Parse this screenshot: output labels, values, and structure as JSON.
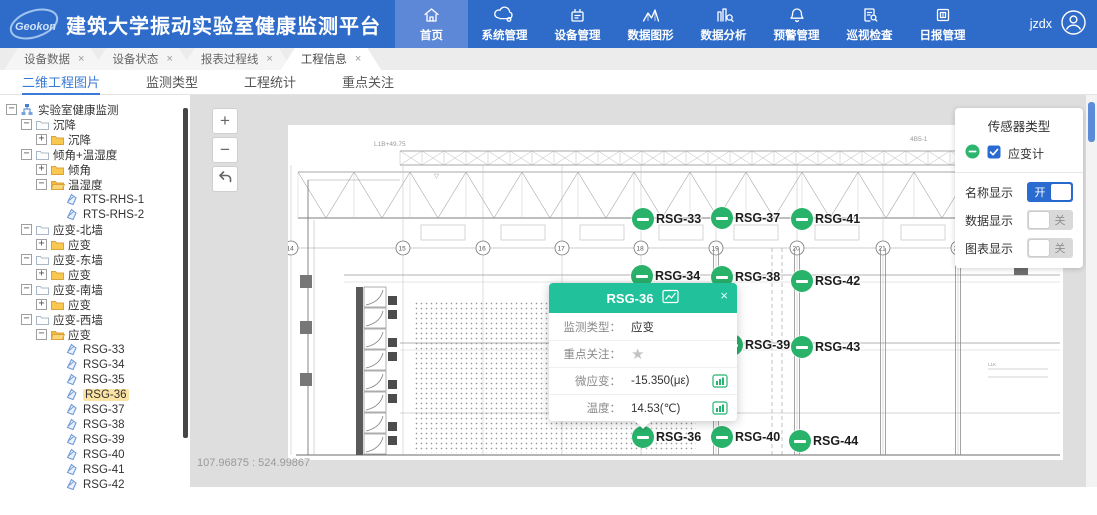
{
  "header": {
    "logo_text": "Geokon",
    "title": "建筑大学振动实验室健康监测平台",
    "user": "jzdx",
    "nav": [
      {
        "label": "首页",
        "icon": "home-icon",
        "active": true
      },
      {
        "label": "系统管理",
        "icon": "cloud-gear-icon"
      },
      {
        "label": "设备管理",
        "icon": "device-icon"
      },
      {
        "label": "数据图形",
        "icon": "chart-icon"
      },
      {
        "label": "数据分析",
        "icon": "analysis-icon"
      },
      {
        "label": "预警管理",
        "icon": "bell-icon"
      },
      {
        "label": "巡视检查",
        "icon": "inspect-icon"
      },
      {
        "label": "日报管理",
        "icon": "report-icon"
      }
    ]
  },
  "window_tabs": [
    {
      "label": "设备数据",
      "close": "×",
      "active": false
    },
    {
      "label": "设备状态",
      "close": "×",
      "active": false
    },
    {
      "label": "报表过程线",
      "close": "×",
      "active": false
    },
    {
      "label": "工程信息",
      "close": "×",
      "active": true
    }
  ],
  "subtabs": [
    {
      "label": "二维工程图片",
      "active": true
    },
    {
      "label": "监测类型",
      "active": false
    },
    {
      "label": "工程统计",
      "active": false
    },
    {
      "label": "重点关注",
      "active": false
    }
  ],
  "tree": {
    "items": [
      {
        "label": "实验室健康监测",
        "level": 0,
        "exp": "−",
        "icon": "org-icon"
      },
      {
        "label": "沉降",
        "level": 1,
        "exp": "−",
        "icon": "folder-light-icon"
      },
      {
        "label": "沉降",
        "level": 2,
        "exp": "+",
        "icon": "folder-icon"
      },
      {
        "label": "倾角+温湿度",
        "level": 1,
        "exp": "−",
        "icon": "folder-light-icon"
      },
      {
        "label": "倾角",
        "level": 2,
        "exp": "+",
        "icon": "folder-icon"
      },
      {
        "label": "温湿度",
        "level": 2,
        "exp": "−",
        "icon": "folder-open-icon"
      },
      {
        "label": "RTS-RHS-1",
        "level": 3,
        "icon": "sensor-icon"
      },
      {
        "label": "RTS-RHS-2",
        "level": 3,
        "icon": "sensor-icon"
      },
      {
        "label": "应变-北墙",
        "level": 1,
        "exp": "−",
        "icon": "folder-light-icon"
      },
      {
        "label": "应变",
        "level": 2,
        "exp": "+",
        "icon": "folder-icon"
      },
      {
        "label": "应变-东墙",
        "level": 1,
        "exp": "−",
        "icon": "folder-light-icon"
      },
      {
        "label": "应变",
        "level": 2,
        "exp": "+",
        "icon": "folder-icon"
      },
      {
        "label": "应变-南墙",
        "level": 1,
        "exp": "−",
        "icon": "folder-light-icon"
      },
      {
        "label": "应变",
        "level": 2,
        "exp": "+",
        "icon": "folder-icon"
      },
      {
        "label": "应变-西墙",
        "level": 1,
        "exp": "−",
        "icon": "folder-light-icon"
      },
      {
        "label": "应变",
        "level": 2,
        "exp": "−",
        "icon": "folder-open-icon"
      },
      {
        "label": "RSG-33",
        "level": 3,
        "icon": "sensor-icon"
      },
      {
        "label": "RSG-34",
        "level": 3,
        "icon": "sensor-icon"
      },
      {
        "label": "RSG-35",
        "level": 3,
        "icon": "sensor-icon"
      },
      {
        "label": "RSG-36",
        "level": 3,
        "icon": "sensor-icon",
        "selected": true
      },
      {
        "label": "RSG-37",
        "level": 3,
        "icon": "sensor-icon"
      },
      {
        "label": "RSG-38",
        "level": 3,
        "icon": "sensor-icon"
      },
      {
        "label": "RSG-39",
        "level": 3,
        "icon": "sensor-icon"
      },
      {
        "label": "RSG-40",
        "level": 3,
        "icon": "sensor-icon"
      },
      {
        "label": "RSG-41",
        "level": 3,
        "icon": "sensor-icon"
      },
      {
        "label": "RSG-42",
        "level": 3,
        "icon": "sensor-icon"
      }
    ]
  },
  "canvas": {
    "zoom_in": "+",
    "zoom_out": "−",
    "coordinates": "107.96875 : 524.99867",
    "grid_bubbles": [
      {
        "n": "14",
        "x": 3
      },
      {
        "n": "15",
        "x": 115
      },
      {
        "n": "16",
        "x": 195
      },
      {
        "n": "17",
        "x": 274
      },
      {
        "n": "18",
        "x": 353
      },
      {
        "n": "19",
        "x": 428
      },
      {
        "n": "20",
        "x": 509
      },
      {
        "n": "21",
        "x": 595
      },
      {
        "n": "22",
        "x": 670
      }
    ],
    "annotations": [
      {
        "text": "L1B+49.75",
        "x": 86,
        "y": 21
      },
      {
        "text": "4B5-1",
        "x": 622,
        "y": 16
      },
      {
        "text": "▽",
        "x": 146,
        "y": 53
      },
      {
        "text": "▽",
        "x": 752,
        "y": 38
      }
    ],
    "markers": [
      {
        "id": "RSG-33",
        "x": 355,
        "y": 94
      },
      {
        "id": "RSG-37",
        "x": 434,
        "y": 93
      },
      {
        "id": "RSG-41",
        "x": 514,
        "y": 94
      },
      {
        "id": "RSG-34",
        "x": 354,
        "y": 151
      },
      {
        "id": "RSG-38",
        "x": 434,
        "y": 152
      },
      {
        "id": "RSG-42",
        "x": 514,
        "y": 156
      },
      {
        "id": "RSG-35",
        "x": 355,
        "y": 220
      },
      {
        "id": "RSG-39",
        "x": 444,
        "y": 220
      },
      {
        "id": "RSG-43",
        "x": 514,
        "y": 222
      },
      {
        "id": "RSG-36",
        "x": 355,
        "y": 312
      },
      {
        "id": "RSG-40",
        "x": 434,
        "y": 312
      },
      {
        "id": "RSG-44",
        "x": 512,
        "y": 316
      }
    ]
  },
  "popup": {
    "title": "RSG-36",
    "close": "×",
    "rows": [
      {
        "label": "监测类型：",
        "value": "应变"
      },
      {
        "label": "重点关注：",
        "value": "★",
        "star": true
      },
      {
        "label": "微应变：",
        "value": "-15.350(με)",
        "chart": true
      },
      {
        "label": "温度：",
        "value": "14.53(℃)",
        "chart": true
      }
    ]
  },
  "sensor_panel": {
    "title": "传感器类型",
    "type_label": "应变计",
    "toggles": [
      {
        "label": "名称显示",
        "state": "开",
        "on": true
      },
      {
        "label": "数据显示",
        "state": "关",
        "on": false
      },
      {
        "label": "图表显示",
        "state": "关",
        "on": false
      }
    ]
  }
}
